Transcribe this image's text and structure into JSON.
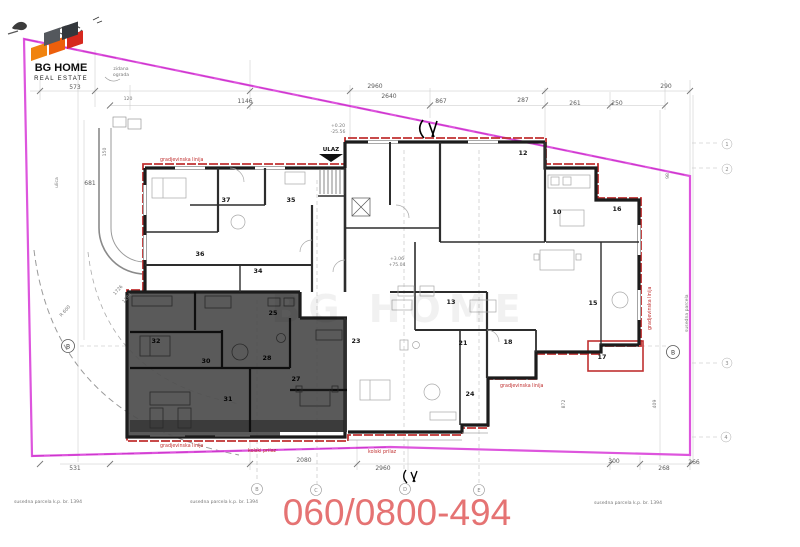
{
  "logo": {
    "line1": "BG HOME",
    "line2": "REAL ESTATE"
  },
  "phone": "060/0800-494",
  "watermark": "BG HOME",
  "labels": {
    "ulaz": "ULAZ",
    "building_line_1": "gradjevinska linija",
    "building_line_2": "gradjevinska linija",
    "building_line_3": "gradjevinska linija",
    "building_line_4": "gradjevinska linija",
    "access_1": "kolski prilaz",
    "access_2": "kolski prilaz",
    "parcel_1": "susedna parcela k.p. br. 1394",
    "parcel_2": "susedna parcela k.p. br. 1394",
    "parcel_3": "susedna parcela k.p. br. 1394",
    "parcel_side": "susedna parcela",
    "fence_1": "zidana",
    "fence_2": "ograda",
    "street": "ulica"
  },
  "levels": {
    "l1": "+0.20",
    "l2": "-25.56",
    "l3": "+3.06",
    "l4": "+75.04"
  },
  "dims": {
    "top": [
      "573",
      "120",
      "1146",
      "2960",
      "2640",
      "867",
      "287",
      "261",
      "250",
      "290"
    ],
    "bottom": [
      "531",
      "2080",
      "2960",
      "300",
      "268",
      "266"
    ],
    "left": [
      "150",
      "681",
      "1726",
      "1194",
      "R 600"
    ],
    "right": [
      "98",
      "409",
      "872"
    ]
  },
  "rooms": [
    {
      "n": "37"
    },
    {
      "n": "35"
    },
    {
      "n": "36"
    },
    {
      "n": "34"
    },
    {
      "n": "25"
    },
    {
      "n": "32"
    },
    {
      "n": "30"
    },
    {
      "n": "28"
    },
    {
      "n": "27"
    },
    {
      "n": "31"
    },
    {
      "n": "23"
    },
    {
      "n": "21"
    },
    {
      "n": "18"
    },
    {
      "n": "24"
    },
    {
      "n": "13"
    },
    {
      "n": "15"
    },
    {
      "n": "17"
    },
    {
      "n": "16"
    },
    {
      "n": "10"
    },
    {
      "n": "12"
    }
  ],
  "axes": {
    "left_b": "B",
    "right_b": "B",
    "bot_1": "B",
    "bot_2": "C",
    "bot_3": "D",
    "bot_4": "E",
    "r1": "1",
    "r2": "2",
    "r3": "3",
    "r4": "4"
  },
  "colors": {
    "boundary": "#dd55dd",
    "building_line": "#c03030",
    "highlight_fill": "#4e4e4e",
    "phone": "#e57373",
    "logo_orange": "#f0830f",
    "logo_red": "#d6281e",
    "logo_slate": "#33373c"
  }
}
